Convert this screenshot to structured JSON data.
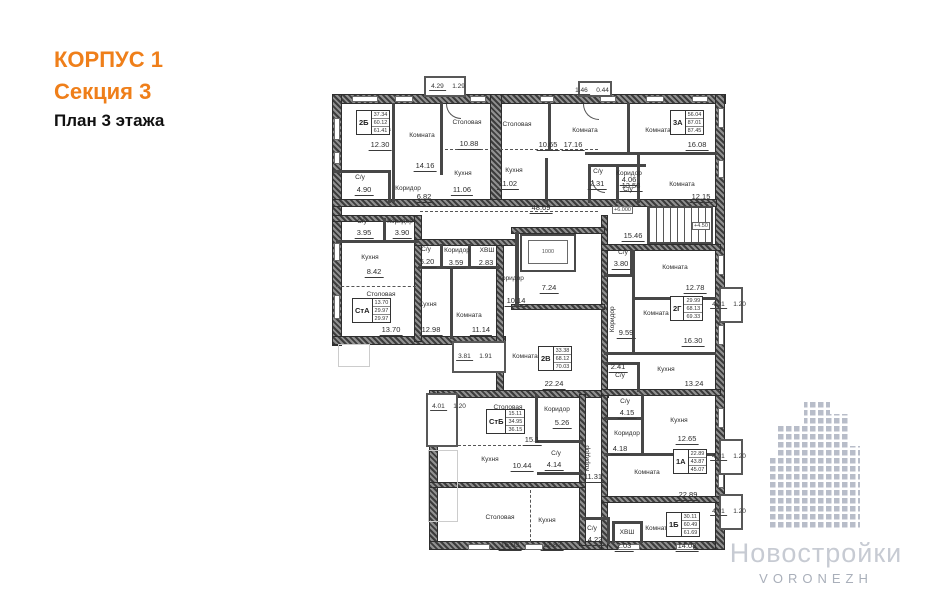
{
  "title": {
    "line1": "КОРПУС 1",
    "line2": "Секция 3",
    "line3": "План 3 этажа"
  },
  "colors": {
    "accent": "#ef7f1a",
    "wall": "#3c3c3c",
    "watermark_text": "#c7cbd3",
    "watermark_city": "#a9afba"
  },
  "watermark": {
    "brand": "Новостройки",
    "city": "VORONEZH"
  },
  "plan": {
    "labels": [
      {
        "t": "Комната",
        "x": 378,
        "y": 127
      },
      {
        "t": "12.30",
        "x": 380,
        "y": 141,
        "u": 1
      },
      {
        "t": "Комната",
        "x": 422,
        "y": 133
      },
      {
        "t": "14.16",
        "x": 425,
        "y": 162,
        "u": 1
      },
      {
        "t": "Столовая",
        "x": 467,
        "y": 120
      },
      {
        "t": "10.88",
        "x": 469,
        "y": 140,
        "u": 1
      },
      {
        "t": "Кухня",
        "x": 463,
        "y": 171
      },
      {
        "t": "11.06",
        "x": 462,
        "y": 186,
        "u": 1
      },
      {
        "t": "С/у",
        "x": 360,
        "y": 175
      },
      {
        "t": "4.90",
        "x": 364,
        "y": 186,
        "u": 1
      },
      {
        "t": "Коридор",
        "x": 408,
        "y": 186
      },
      {
        "t": "6.82",
        "x": 424,
        "y": 193,
        "u": 1
      },
      {
        "t": "Столовая",
        "x": 517,
        "y": 122
      },
      {
        "t": "10.65",
        "x": 548,
        "y": 141,
        "u": 1
      },
      {
        "t": "Кухня",
        "x": 514,
        "y": 168
      },
      {
        "t": "11.02",
        "x": 508,
        "y": 180,
        "u": 1
      },
      {
        "t": "Комната",
        "x": 585,
        "y": 128
      },
      {
        "t": "17.16",
        "x": 573,
        "y": 141,
        "u": 1
      },
      {
        "t": "Комната",
        "x": 658,
        "y": 128
      },
      {
        "t": "16.08",
        "x": 697,
        "y": 141,
        "u": 1
      },
      {
        "t": "Коридор",
        "x": 629,
        "y": 171
      },
      {
        "t": "13.58",
        "x": 631,
        "y": 182,
        "u": 1
      },
      {
        "t": "С/у",
        "x": 598,
        "y": 169
      },
      {
        "t": "2.31",
        "x": 597,
        "y": 180,
        "u": 1
      },
      {
        "t": "4.06",
        "x": 629,
        "y": 176,
        "u": 1
      },
      {
        "t": "С/у",
        "x": 628,
        "y": 187
      },
      {
        "t": "Комната",
        "x": 682,
        "y": 182
      },
      {
        "t": "12.15",
        "x": 701,
        "y": 193,
        "u": 1
      },
      {
        "t": "48.69",
        "x": 541,
        "y": 204,
        "u": 1
      },
      {
        "t": "15.46",
        "x": 633,
        "y": 232,
        "u": 1
      },
      {
        "t": "7.24",
        "x": 549,
        "y": 284,
        "u": 1
      },
      {
        "t": "Коридор",
        "x": 511,
        "y": 276
      },
      {
        "t": "10.14",
        "x": 516,
        "y": 297,
        "u": 1
      },
      {
        "t": "1000",
        "x": 548,
        "y": 250,
        "cls": "tiny"
      },
      {
        "t": "С/у",
        "x": 362,
        "y": 219
      },
      {
        "t": "3.95",
        "x": 364,
        "y": 229,
        "u": 1
      },
      {
        "t": "Коридор",
        "x": 400,
        "y": 219
      },
      {
        "t": "3.90",
        "x": 402,
        "y": 229,
        "u": 1
      },
      {
        "t": "Кухня",
        "x": 370,
        "y": 255
      },
      {
        "t": "8.42",
        "x": 374,
        "y": 268,
        "u": 1
      },
      {
        "t": "Столовая",
        "x": 381,
        "y": 292
      },
      {
        "t": "13.70",
        "x": 391,
        "y": 326,
        "u": 1
      },
      {
        "t": "С/у",
        "x": 426,
        "y": 247
      },
      {
        "t": "5.20",
        "x": 427,
        "y": 258,
        "u": 1
      },
      {
        "t": "Коридор",
        "x": 457,
        "y": 248
      },
      {
        "t": "3.59",
        "x": 456,
        "y": 259,
        "u": 1
      },
      {
        "t": "ХВШ",
        "x": 487,
        "y": 248
      },
      {
        "t": "2.83",
        "x": 486,
        "y": 259,
        "u": 1
      },
      {
        "t": "Кухня",
        "x": 428,
        "y": 302
      },
      {
        "t": "12.98",
        "x": 431,
        "y": 326,
        "u": 1
      },
      {
        "t": "Комната",
        "x": 469,
        "y": 313
      },
      {
        "t": "11.14",
        "x": 481,
        "y": 326,
        "u": 1
      },
      {
        "t": "Комната",
        "x": 525,
        "y": 354
      },
      {
        "t": "22.24",
        "x": 554,
        "y": 380,
        "u": 1
      },
      {
        "t": "С/у",
        "x": 623,
        "y": 250
      },
      {
        "t": "3.80",
        "x": 621,
        "y": 260,
        "u": 1
      },
      {
        "t": "Комната",
        "x": 675,
        "y": 265
      },
      {
        "t": "12.78",
        "x": 695,
        "y": 284,
        "u": 1
      },
      {
        "t": "Комната",
        "x": 656,
        "y": 311
      },
      {
        "t": "16.30",
        "x": 693,
        "y": 337,
        "u": 1
      },
      {
        "t": "Коридор",
        "x": 613,
        "y": 316,
        "rot": 1
      },
      {
        "t": "9.59",
        "x": 626,
        "y": 329,
        "u": 1
      },
      {
        "t": "2.41",
        "x": 618,
        "y": 363,
        "u": 1
      },
      {
        "t": "С/у",
        "x": 620,
        "y": 373
      },
      {
        "t": "Кухня",
        "x": 666,
        "y": 367
      },
      {
        "t": "13.24",
        "x": 694,
        "y": 380,
        "u": 1
      },
      {
        "t": "С/у",
        "x": 625,
        "y": 399
      },
      {
        "t": "4.15",
        "x": 627,
        "y": 409,
        "u": 1
      },
      {
        "t": "Кухня",
        "x": 679,
        "y": 418
      },
      {
        "t": "12.65",
        "x": 687,
        "y": 435,
        "u": 1
      },
      {
        "t": "Коридор",
        "x": 627,
        "y": 431
      },
      {
        "t": "4.18",
        "x": 620,
        "y": 445,
        "u": 1
      },
      {
        "t": "Комната",
        "x": 647,
        "y": 470
      },
      {
        "t": "22.89",
        "x": 688,
        "y": 491,
        "u": 1
      },
      {
        "t": "Коридор",
        "x": 588,
        "y": 455,
        "rot": 1
      },
      {
        "t": "11.31",
        "x": 593,
        "y": 473,
        "u": 1
      },
      {
        "t": "Столовая",
        "x": 500,
        "y": 515
      },
      {
        "t": "16.03",
        "x": 510,
        "y": 541,
        "u": 1
      },
      {
        "t": "Кухня",
        "x": 547,
        "y": 518
      },
      {
        "t": "12.82",
        "x": 552,
        "y": 541,
        "u": 1
      },
      {
        "t": "С/у",
        "x": 592,
        "y": 526
      },
      {
        "t": "4.22",
        "x": 595,
        "y": 536,
        "u": 1
      },
      {
        "t": "ХВШ",
        "x": 627,
        "y": 530
      },
      {
        "t": "2.03",
        "x": 624,
        "y": 542,
        "u": 1
      },
      {
        "t": "Комната",
        "x": 658,
        "y": 526
      },
      {
        "t": "14.08",
        "x": 687,
        "y": 542,
        "u": 1
      },
      {
        "t": "Столовая",
        "x": 508,
        "y": 405
      },
      {
        "t": "15.1",
        "x": 532,
        "y": 436,
        "u": 1
      },
      {
        "t": "Коридор",
        "x": 557,
        "y": 407
      },
      {
        "t": "5.26",
        "x": 562,
        "y": 419,
        "u": 1
      },
      {
        "t": "Кухня",
        "x": 490,
        "y": 457
      },
      {
        "t": "10.44",
        "x": 522,
        "y": 462,
        "u": 1
      },
      {
        "t": "С/у",
        "x": 556,
        "y": 451
      },
      {
        "t": "4.14",
        "x": 554,
        "y": 461,
        "u": 1
      }
    ],
    "stamps": [
      {
        "code": "2Б",
        "v1": "37.34",
        "v2": "60.12",
        "v3": "61.41",
        "x": 356,
        "y": 110
      },
      {
        "code": "3А",
        "v1": "56.04",
        "v2": "87.01",
        "v3": "87.45",
        "x": 670,
        "y": 110
      },
      {
        "code": "СтА",
        "v1": "13.70",
        "v2": "29.97",
        "v3": "29.97",
        "x": 352,
        "y": 298
      },
      {
        "code": "2В",
        "v1": "33.38",
        "v2": "68.12",
        "v3": "70.03",
        "x": 538,
        "y": 346
      },
      {
        "code": "2Г",
        "v1": "29.99",
        "v2": "68.13",
        "v3": "69.33",
        "x": 670,
        "y": 296
      },
      {
        "code": "СтБ",
        "v1": "15.11",
        "v2": "34.95",
        "v3": "36.15",
        "x": 486,
        "y": 409
      },
      {
        "code": "1А",
        "v1": "22.89",
        "v2": "43.87",
        "v3": "45.07",
        "x": 673,
        "y": 449
      },
      {
        "code": "1Б",
        "v1": "30.11",
        "v2": "60.49",
        "v3": "61.69",
        "x": 666,
        "y": 512
      }
    ],
    "balconies": [
      {
        "v1": "4.29",
        "v2": "1.29",
        "x": 448,
        "y": 75
      },
      {
        "v1": "1.46",
        "v2": "0.44",
        "x": 592,
        "y": 79
      },
      {
        "v1": "3.81",
        "v2": "1.91",
        "x": 475,
        "y": 345
      },
      {
        "v1": "4.01",
        "v2": "1.20",
        "x": 449,
        "y": 395
      },
      {
        "v1": "4.01",
        "v2": "1.20",
        "x": 729,
        "y": 293
      },
      {
        "v1": "4.01",
        "v2": "1.20",
        "x": 729,
        "y": 445
      },
      {
        "v1": "4.01",
        "v2": "1.20",
        "x": 729,
        "y": 500
      }
    ],
    "levels": [
      {
        "t": "+6.000",
        "x": 612,
        "y": 206
      },
      {
        "t": "+4.50",
        "x": 692,
        "y": 222
      }
    ]
  }
}
